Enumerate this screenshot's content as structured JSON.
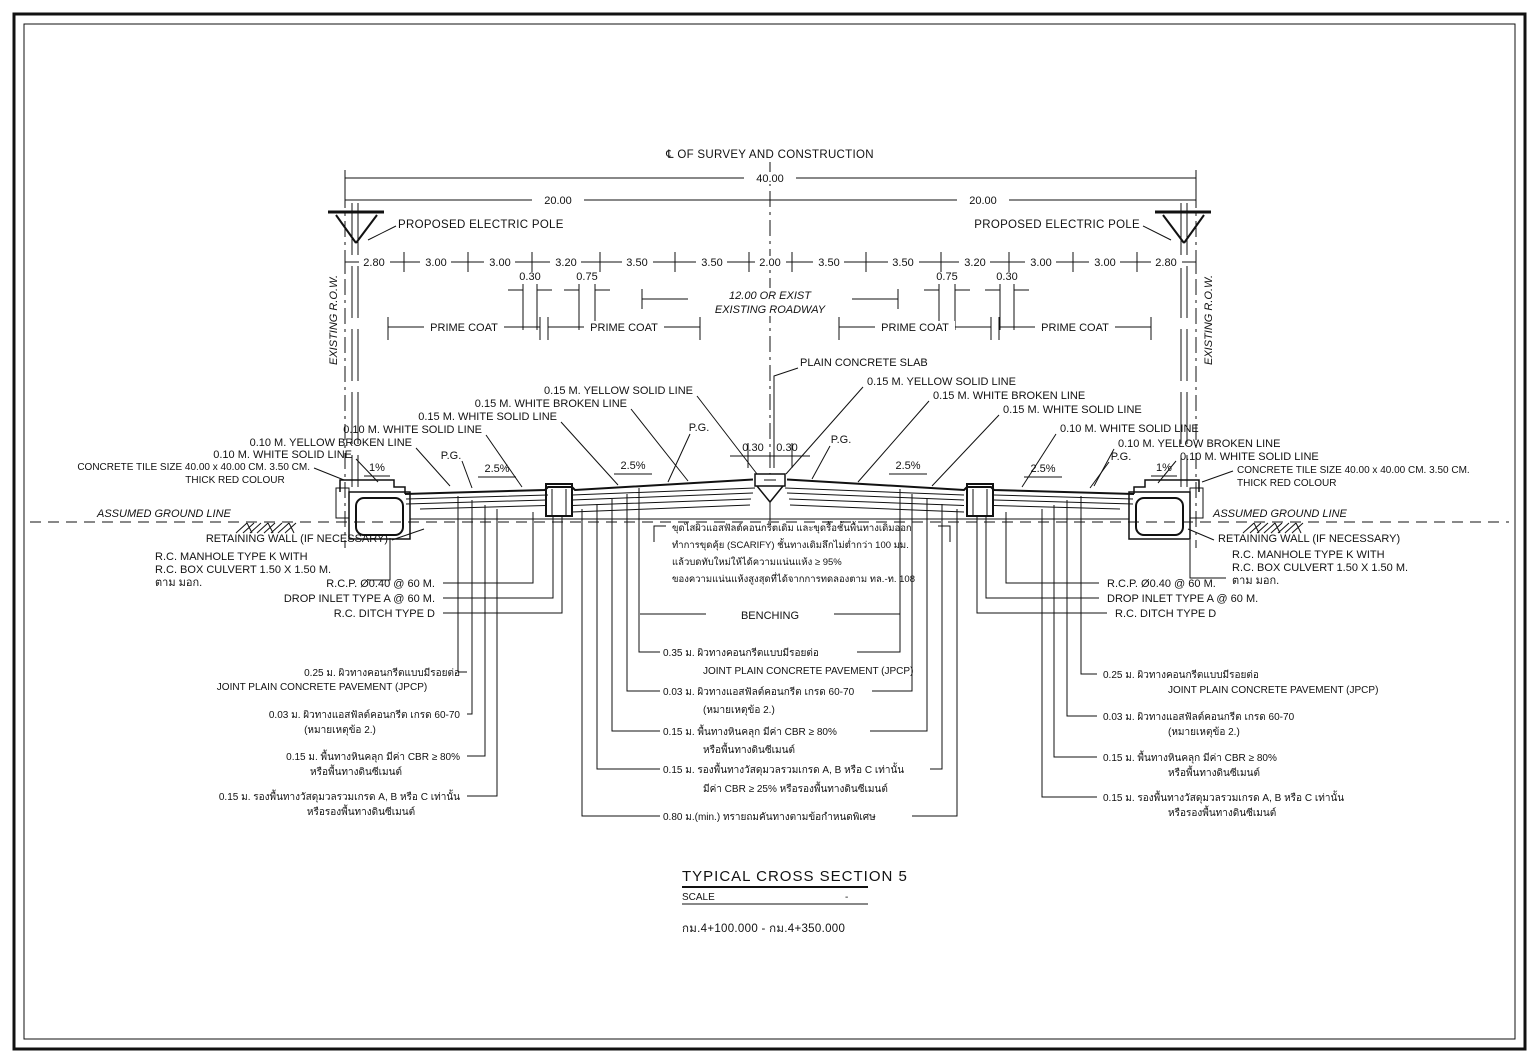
{
  "header": {
    "centerline_label": "℄ OF SURVEY AND CONSTRUCTION",
    "dim_total": "40.00",
    "dim_half_left": "20.00",
    "dim_half_right": "20.00",
    "row_label": "EXISTING R.O.W.",
    "electric_pole_label": "PROPOSED ELECTRIC POLE"
  },
  "dims": {
    "segments": [
      "2.80",
      "3.00",
      "3.00",
      "3.20",
      "3.50",
      "3.50",
      "2.00",
      "3.50",
      "3.50",
      "3.20",
      "3.00",
      "3.00",
      "2.80"
    ],
    "sub": [
      "0.30",
      "0.75",
      "0.75",
      "0.30"
    ],
    "center_left": "0.30",
    "center_right": "0.30",
    "roadway_line1": "12.00 OR EXIST",
    "roadway_line2": "EXISTING ROADWAY"
  },
  "surface": {
    "prime_coat": "PRIME COAT",
    "plain_concrete_slab": "PLAIN CONCRETE SLAB",
    "pg": "P.G.",
    "slope_edge": "1%",
    "slope_lane": "2.5%",
    "yellow_solid_15": "0.15 M. YELLOW SOLID LINE",
    "white_broken_15": "0.15 M. WHITE BROKEN LINE",
    "white_solid_15": "0.15 M. WHITE SOLID LINE",
    "white_solid_10": "0.10 M. WHITE SOLID LINE",
    "yellow_broken_10": "0.10 M. YELLOW BROKEN LINE",
    "tile_line1": "CONCRETE TILE SIZE 40.00 x 40.00 CM. 3.50 CM.",
    "tile_line2": "THICK RED COLOUR"
  },
  "ground": {
    "assumed": "ASSUMED GROUND LINE",
    "retaining": "RETAINING WALL (IF NECESSARY)",
    "manhole1": "R.C. MANHOLE TYPE K WITH",
    "manhole2": "R.C. BOX CULVERT 1.50 X 1.50 M.",
    "manhole3": "ตาม มอก.",
    "rcp": "R.C.P. Ø0.40 @ 60 M.",
    "drop_inlet": "DROP INLET TYPE A @ 60 M.",
    "ditch": "R.C. DITCH TYPE D",
    "benching": "BENCHING"
  },
  "note": {
    "line1": "ขุดไสผิวแอสฟัลต์คอนกรีตเดิม และขุดรื้อชั้นพื้นทางเดิมออก",
    "line2": "ทำการขุดคุ้ย (SCARIFY) ชั้นทางเดิมลึกไม่ต่ำกว่า 100 มม.",
    "line3": "แล้วบดทับใหม่ให้ได้ความแน่นแห้ง ≥ 95%",
    "line4": "ของความแน่นแห้งสูงสุดที่ได้จากการทดลองตาม ทล.-ท. 108"
  },
  "layers_center": [
    {
      "line1": "0.35 ม.  ผิวทางคอนกรีตแบบมีรอยต่อ",
      "line2": "JOINT PLAIN CONCRETE PAVEMENT (JPCP)"
    },
    {
      "line1": "0.03 ม.  ผิวทางแอสฟัลต์คอนกรีต เกรด 60-70",
      "line2": "(หมายเหตุข้อ 2.)"
    },
    {
      "line1": "0.15 ม.  พื้นทางหินคลุก มีค่า CBR ≥ 80%",
      "line2": "หรือพื้นทางดินซีเมนต์"
    },
    {
      "line1": "0.15 ม.  รองพื้นทางวัสดุมวลรวมเกรด A, B หรือ C เท่านั้น",
      "line2": "มีค่า CBR ≥ 25% หรือรองพื้นทางดินซีเมนต์"
    },
    {
      "line1": "0.80 ม.(min.)  ทรายถมคันทางตามข้อกำหนดพิเศษ",
      "line2": ""
    }
  ],
  "layers_side": [
    {
      "line1": "0.25 ม.  ผิวทางคอนกรีตแบบมีรอยต่อ",
      "line2": "JOINT PLAIN CONCRETE PAVEMENT (JPCP)"
    },
    {
      "line1": "0.03 ม.  ผิวทางแอสฟัลต์คอนกรีต เกรด 60-70",
      "line2": "(หมายเหตุข้อ 2.)"
    },
    {
      "line1": "0.15 ม.  พื้นทางหินคลุก มีค่า CBR ≥ 80%",
      "line2": "หรือพื้นทางดินซีเมนต์"
    },
    {
      "line1": "0.15 ม.  รองพื้นทางวัสดุมวลรวมเกรด A, B หรือ C เท่านั้น",
      "line2": "หรือรองพื้นทางดินซีเมนต์"
    }
  ],
  "title_block": {
    "title": "TYPICAL CROSS SECTION 5",
    "scale_label": "SCALE",
    "scale_value": "-",
    "station": "กม.4+100.000 - กม.4+350.000"
  }
}
